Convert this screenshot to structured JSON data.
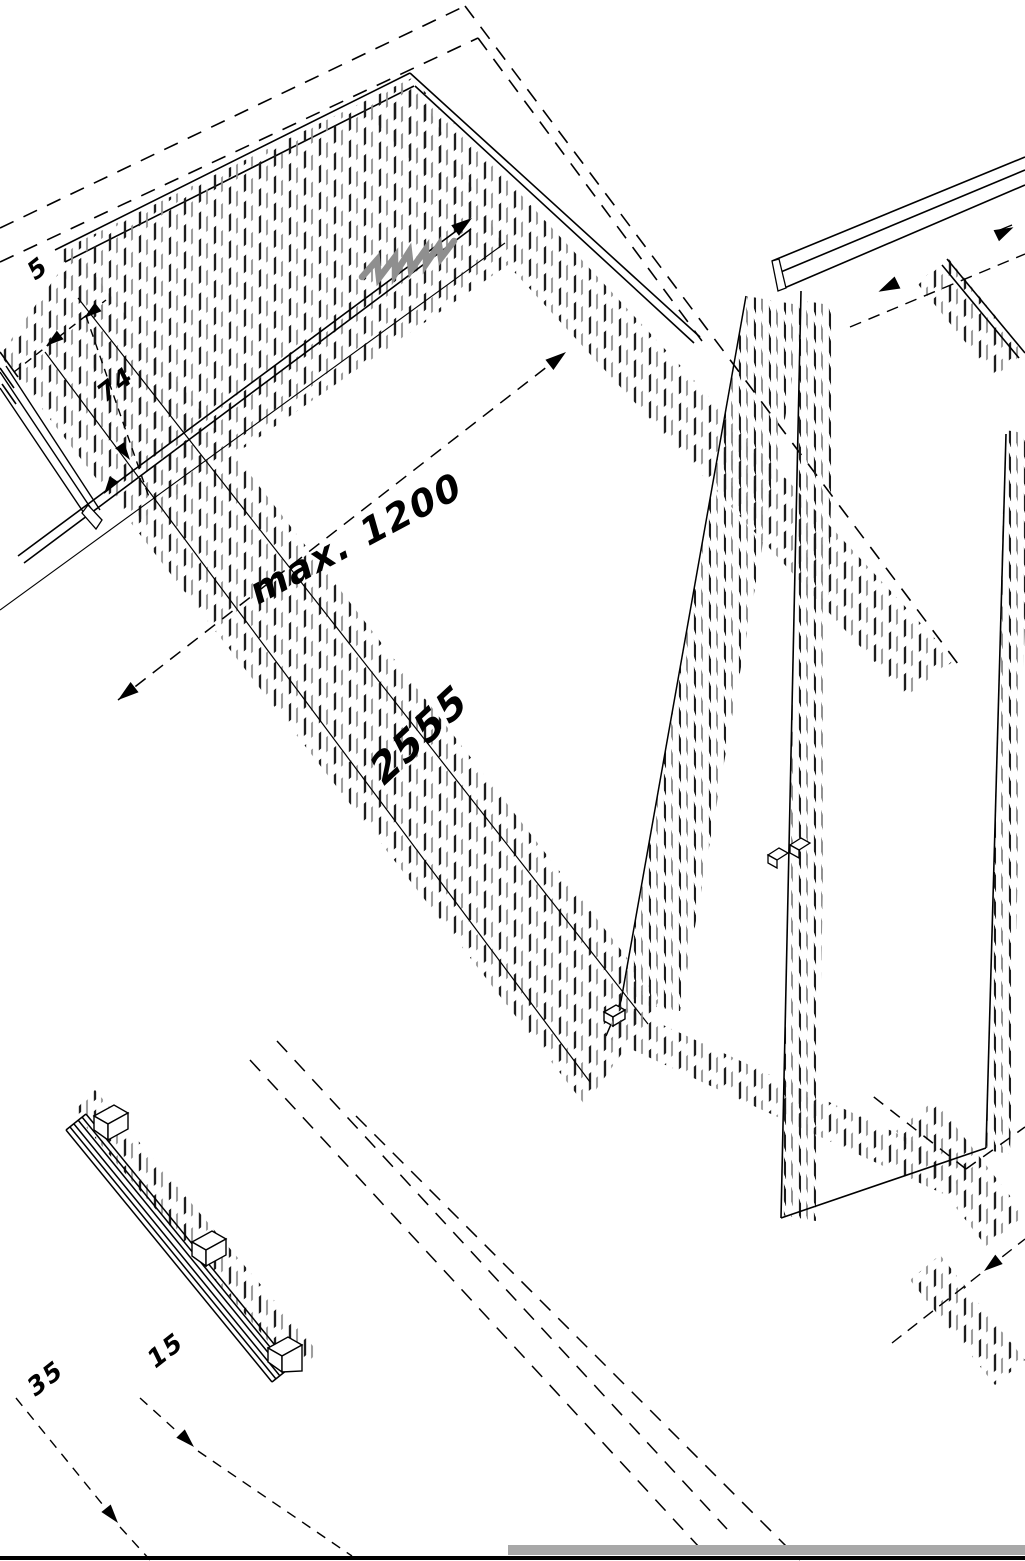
{
  "figure": {
    "type": "isometric-technical-drawing",
    "labels": {
      "dim_max_width": "max. 1200",
      "dim_panel_height": "2555",
      "dim_top_gap": "5",
      "dim_top_offset": "74",
      "dim_bottom_left": "35",
      "dim_bottom_right": "15"
    },
    "colors": {
      "line_black": "#000000",
      "marker_gray": "#8f8f8f",
      "floor_strip_gray": "#a8a8a8",
      "tick_gray": "#8d8d8d"
    }
  }
}
